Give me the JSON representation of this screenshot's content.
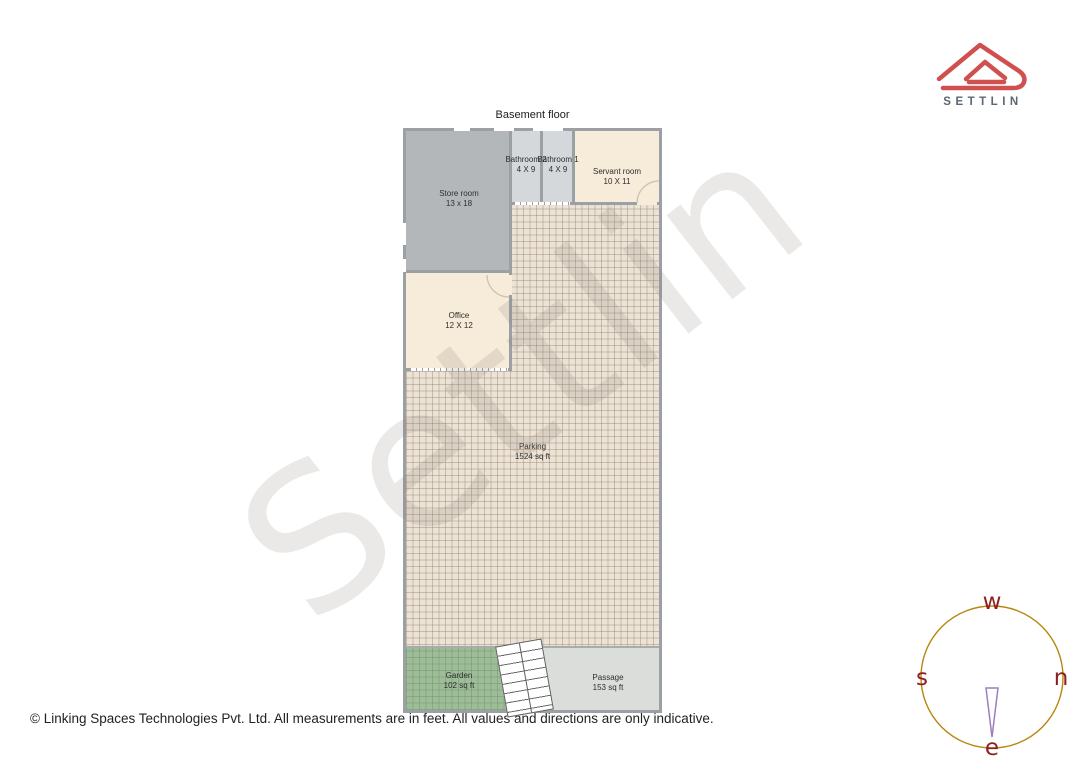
{
  "page": {
    "title": "Basement floor",
    "footer": "© Linking Spaces Technologies Pvt. Ltd. All measurements are in feet. All values and directions are only indicative.",
    "watermark": "Settlin"
  },
  "logo": {
    "brand": "SETTLIN",
    "accent_color": "#d05050",
    "text_color": "#5d6771"
  },
  "compass": {
    "west": "w",
    "north": "n",
    "east": "e",
    "south": "s",
    "needle_points_to": "e",
    "ring_color": "#b8860b",
    "letter_color": "#8e1f1f",
    "needle_color": "#9a7fc0"
  },
  "rooms": [
    {
      "name": "Store room",
      "dims": "13 x 18"
    },
    {
      "name": "Bathroom 2",
      "dims": "4 X 9"
    },
    {
      "name": "Bathroom 1",
      "dims": "4 X 9"
    },
    {
      "name": "Servant room",
      "dims": "10 X 11"
    },
    {
      "name": "Office",
      "dims": "12 X 12"
    },
    {
      "name": "Parking",
      "dims": "1524 sq ft"
    },
    {
      "name": "Garden",
      "dims": "102 sq ft"
    },
    {
      "name": "Passage",
      "dims": "153 sq ft"
    }
  ],
  "colors": {
    "wall": "#9aa0a3",
    "store_fill": "#b4b7ba",
    "bathroom_fill": "#d4d8db",
    "cream_fill": "#f7ebd9",
    "parking_fill": "#ebe3d6",
    "garden_fill": "#9dbd98",
    "passage_fill": "#dbddda"
  }
}
